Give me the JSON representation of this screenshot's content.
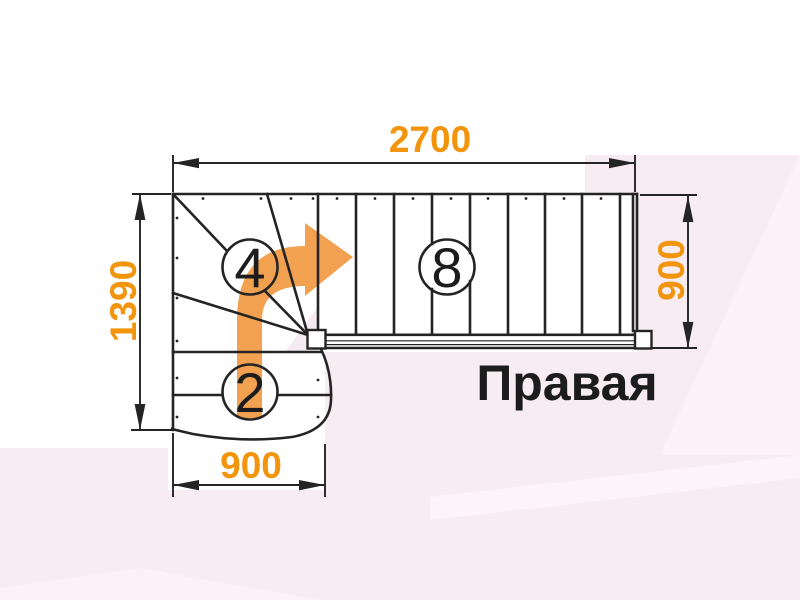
{
  "diagram": {
    "title": "Правая",
    "dim_top": "2700",
    "dim_left": "1390",
    "dim_right": "900",
    "dim_bottom": "900",
    "count_winder": "4",
    "count_straight": "8",
    "count_lower": "2",
    "colors": {
      "dim_text": "#F2940C",
      "arrow": "#F2A150",
      "line": "#242424",
      "title_text": "#1C1C1C",
      "bg_pink": "#F8ECF3",
      "bg_pink_light": "#FBF1F7"
    }
  }
}
